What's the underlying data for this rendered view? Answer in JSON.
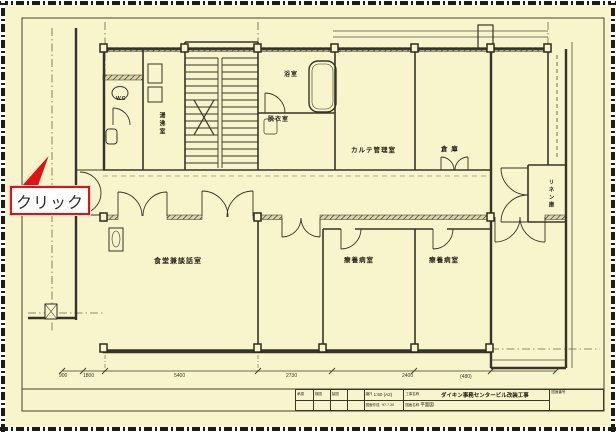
{
  "callout": {
    "label": "クリック"
  },
  "colors": {
    "background": "#f8f4cb",
    "line": "#35342a",
    "accent_red": "#e01212"
  },
  "rooms": {
    "wc": "WC",
    "yuwakashi": "湯沸室",
    "bath": "浴室",
    "datsui": "脱衣室",
    "karte": "カルテ管理室",
    "souko": "倉 庫",
    "linen": "リネン庫",
    "dining": "食堂兼談話室",
    "ward1": "療養病室",
    "ward2": "療養病室"
  },
  "dimensions": {
    "labels": [
      "900",
      "1800",
      "5400",
      "2730",
      "2400",
      "(480)"
    ]
  },
  "title_block": {
    "approvals": [
      "承認",
      "検図",
      "製図"
    ],
    "scale_label": "縮尺",
    "scale_value": "1:50 (A2)",
    "made_label": "図面作成",
    "made_value": "'97.7.30",
    "project_label": "工事名称",
    "project_title": "ダイキン事務センタービル改装工事",
    "drawing_label": "図面名称",
    "drawing_value": "平面図",
    "number_label": "図面番号"
  }
}
